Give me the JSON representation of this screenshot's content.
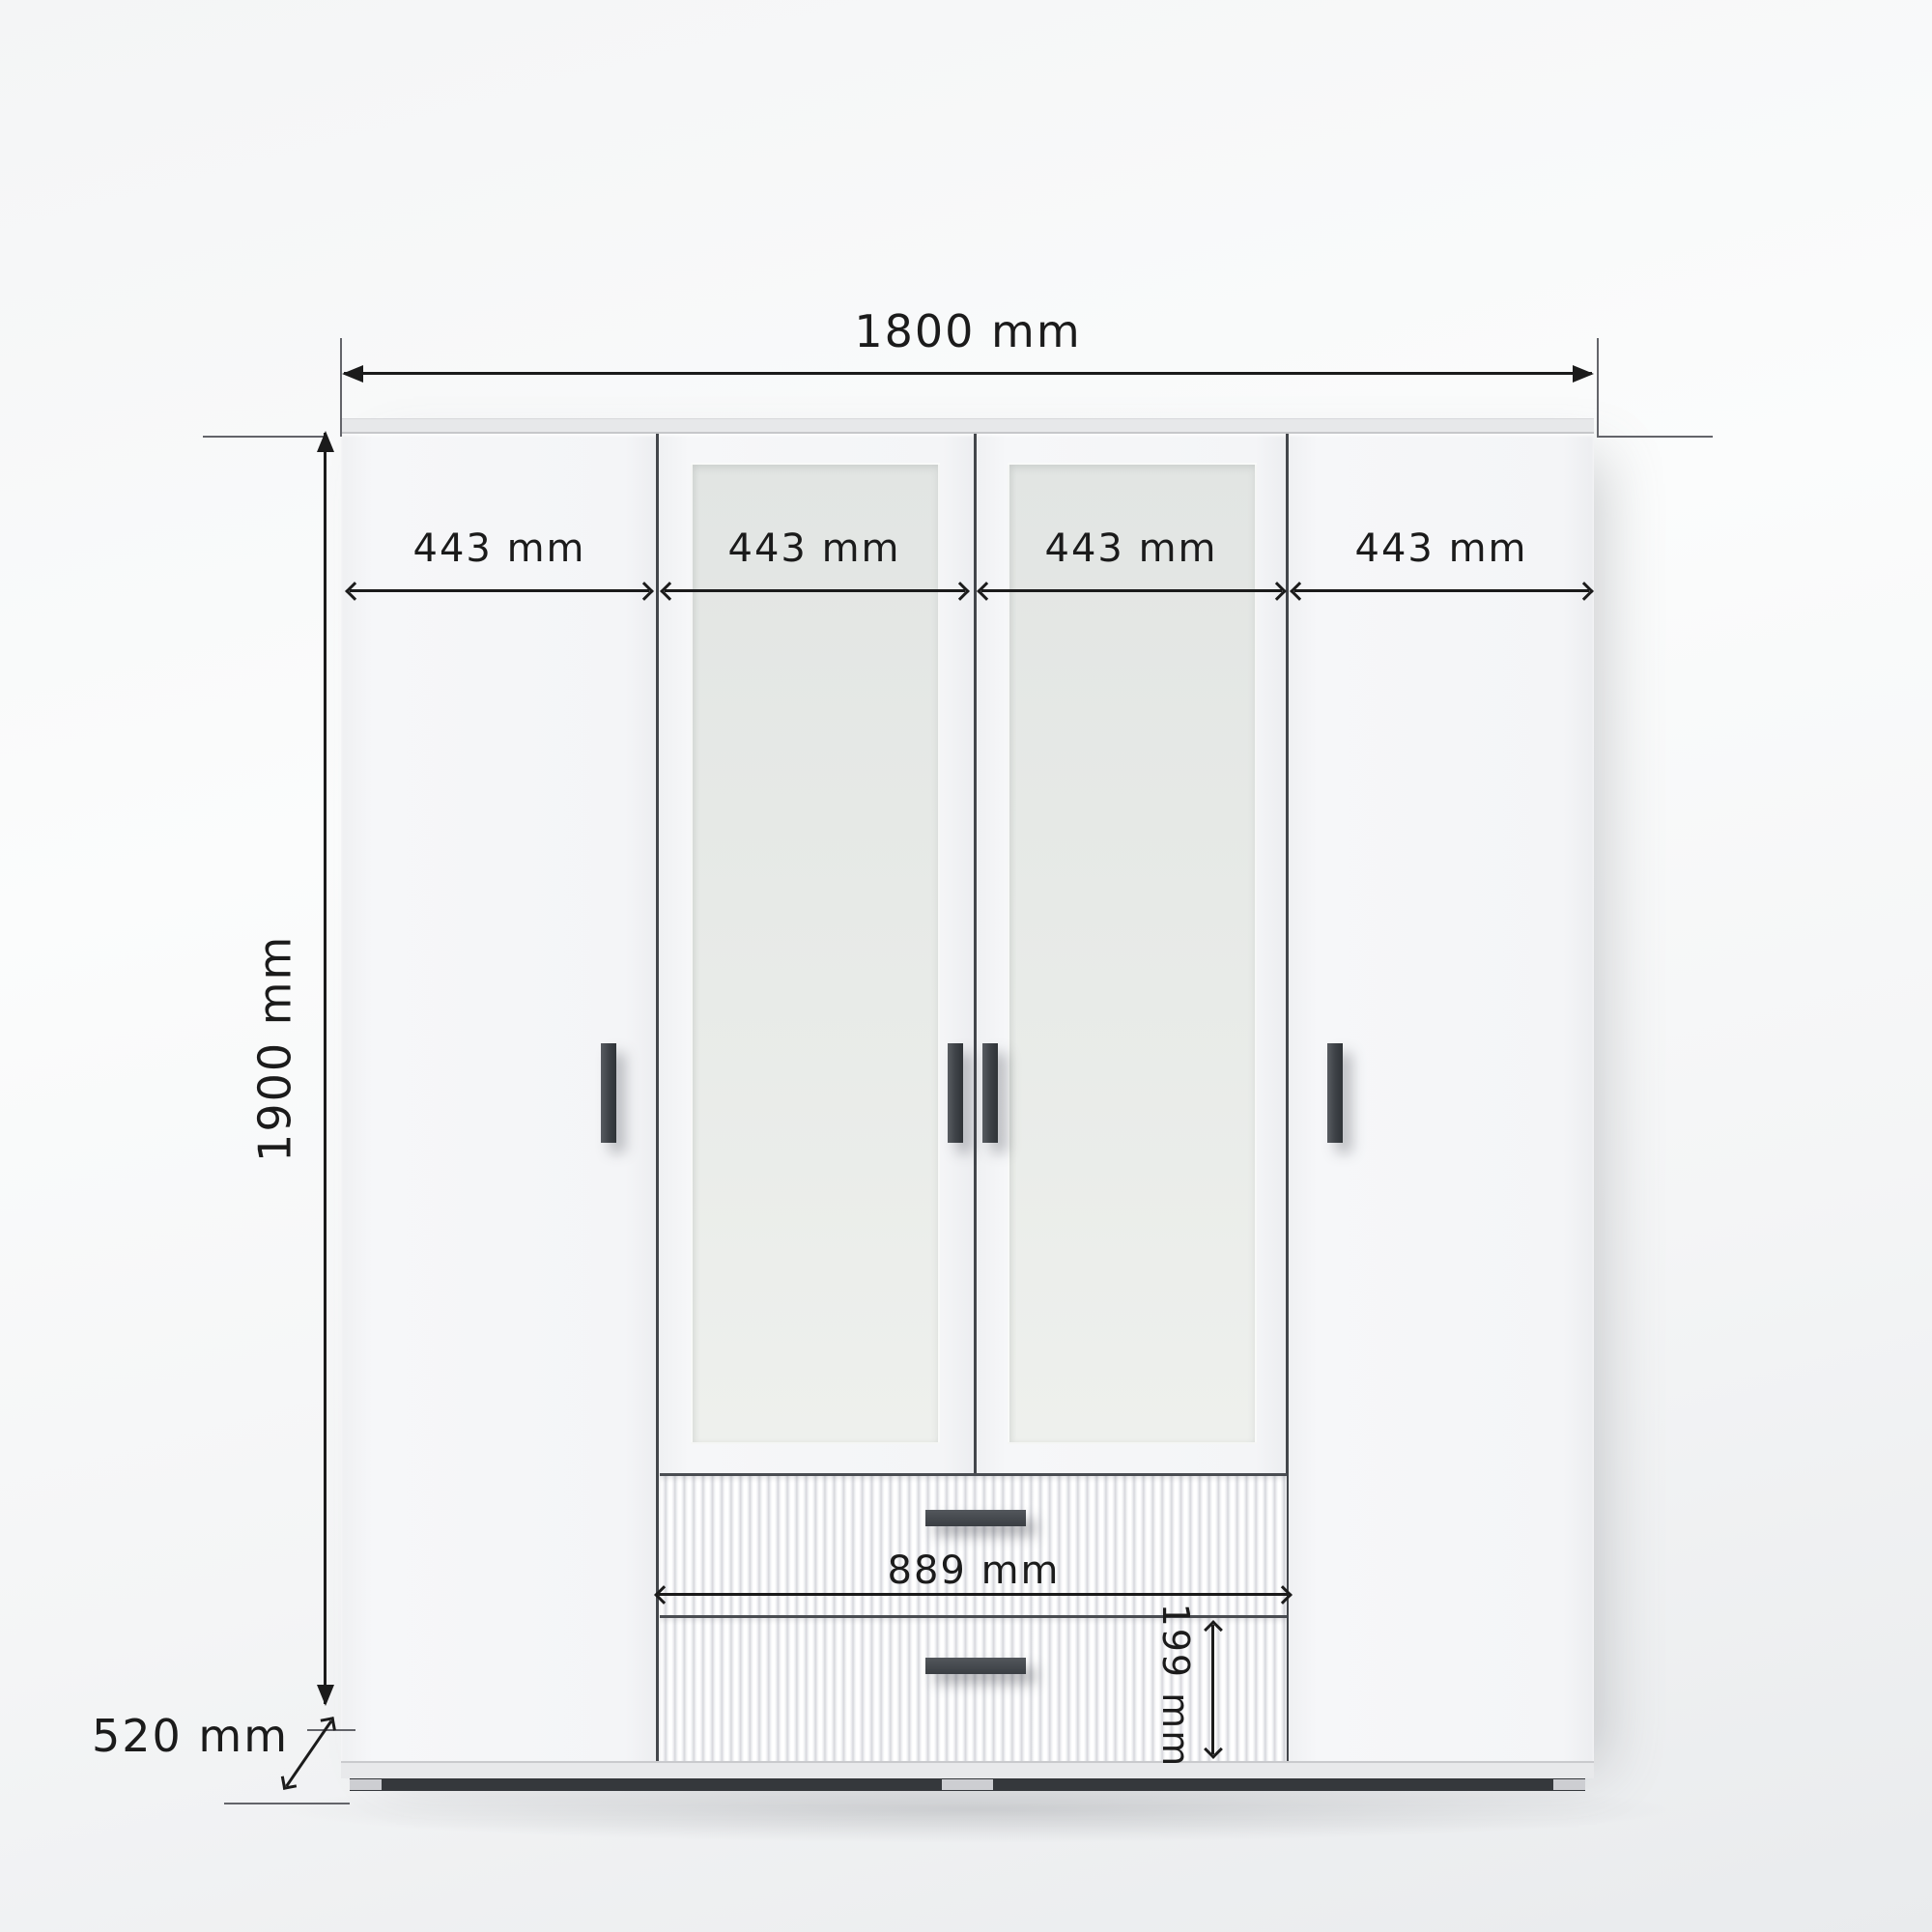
{
  "diagram": {
    "subject": "four-door wardrobe with two mirrored doors and two lower drawers",
    "labels": {
      "overall_width": "1800 mm",
      "overall_height": "1900 mm",
      "depth": "520 mm",
      "drawer_width": "889 mm",
      "drawer_height": "199 mm"
    },
    "door_widths": [
      {
        "label": "443 mm"
      },
      {
        "label": "443 mm"
      },
      {
        "label": "443 mm"
      },
      {
        "label": "443 mm"
      }
    ],
    "colors": {
      "dimension_ink": "#1b1b1b",
      "witness_line": "#63646a",
      "door_fill": "#f4f5f7",
      "mirror_fill": "#e7eae7",
      "handle": "#43474c",
      "plinth_dark": "#35383c",
      "background_top": "#fafbfb",
      "background_bottom": "#e9ebed"
    }
  }
}
